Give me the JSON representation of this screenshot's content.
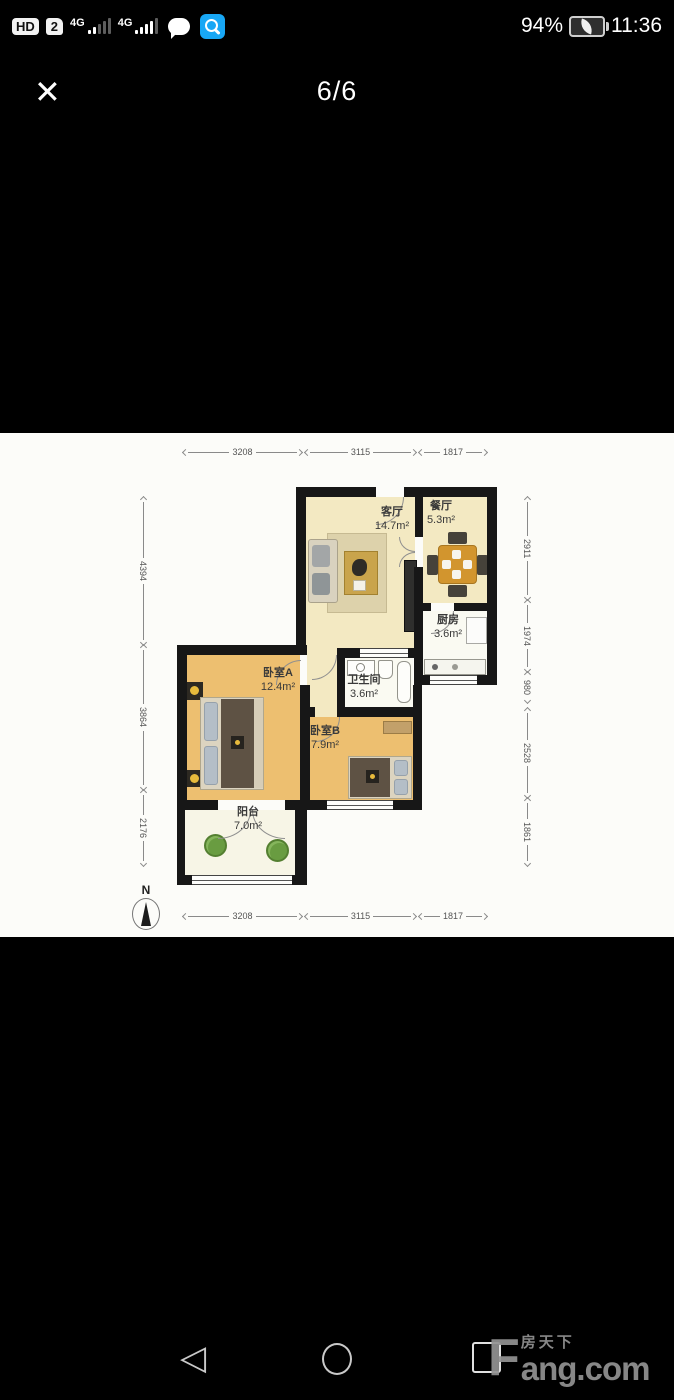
{
  "status_bar": {
    "hd": "HD",
    "sim": "2",
    "net1": "4G",
    "net2": "4G",
    "battery_percent": "94%",
    "time": "11:36"
  },
  "viewer": {
    "close_glyph": "✕",
    "page_indicator": "6/6"
  },
  "floor_plan": {
    "rooms": [
      {
        "name": "客厅",
        "area": "14.7m²"
      },
      {
        "name": "餐厅",
        "area": "5.3m²"
      },
      {
        "name": "厨房",
        "area": "3.6m²"
      },
      {
        "name": "卧室A",
        "area": "12.4m²"
      },
      {
        "name": "卫生间",
        "area": "3.6m²"
      },
      {
        "name": "卧室B",
        "area": "7.9m²"
      },
      {
        "name": "阳台",
        "area": "7.0m²"
      }
    ],
    "dims_top": [
      "3208",
      "3115",
      "1817"
    ],
    "dims_bottom": [
      "3208",
      "3115",
      "1817"
    ],
    "dims_left": [
      "4394",
      "3864",
      "2176"
    ],
    "dims_right": [
      "2911",
      "1974",
      "980",
      "2528",
      "1861"
    ],
    "compass": "N"
  },
  "nav_bar": {
    "back_glyph": "◁"
  },
  "watermark": {
    "initial": "F",
    "cn": "房天下",
    "en": "ang.com"
  },
  "colors": {
    "accent_blue": "#18a7f5",
    "wall": "#171717",
    "floor_cream": "#f3e9c2",
    "floor_wood": "#edbf70"
  }
}
